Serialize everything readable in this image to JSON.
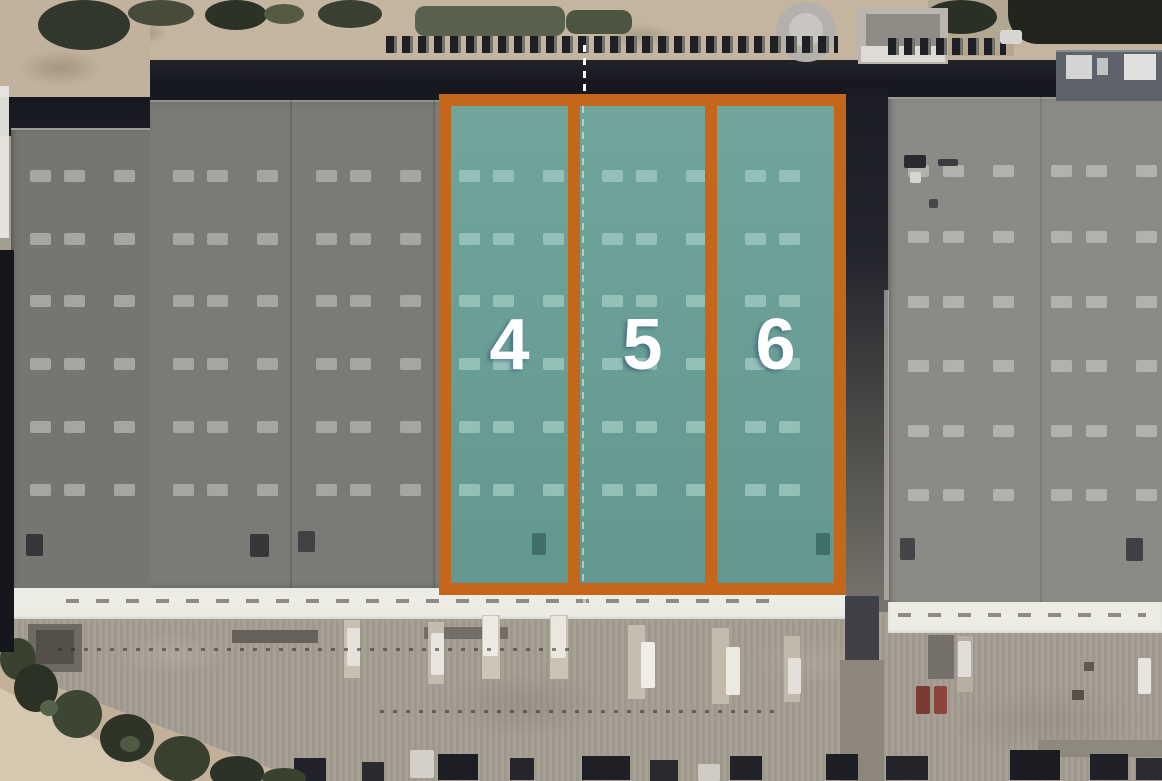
{
  "aerial_map": {
    "highlighted_units": [
      {
        "label": "4"
      },
      {
        "label": "5"
      },
      {
        "label": "6"
      }
    ],
    "highlight_fill_color": "#68A098",
    "highlight_border_color": "#C5671B"
  }
}
